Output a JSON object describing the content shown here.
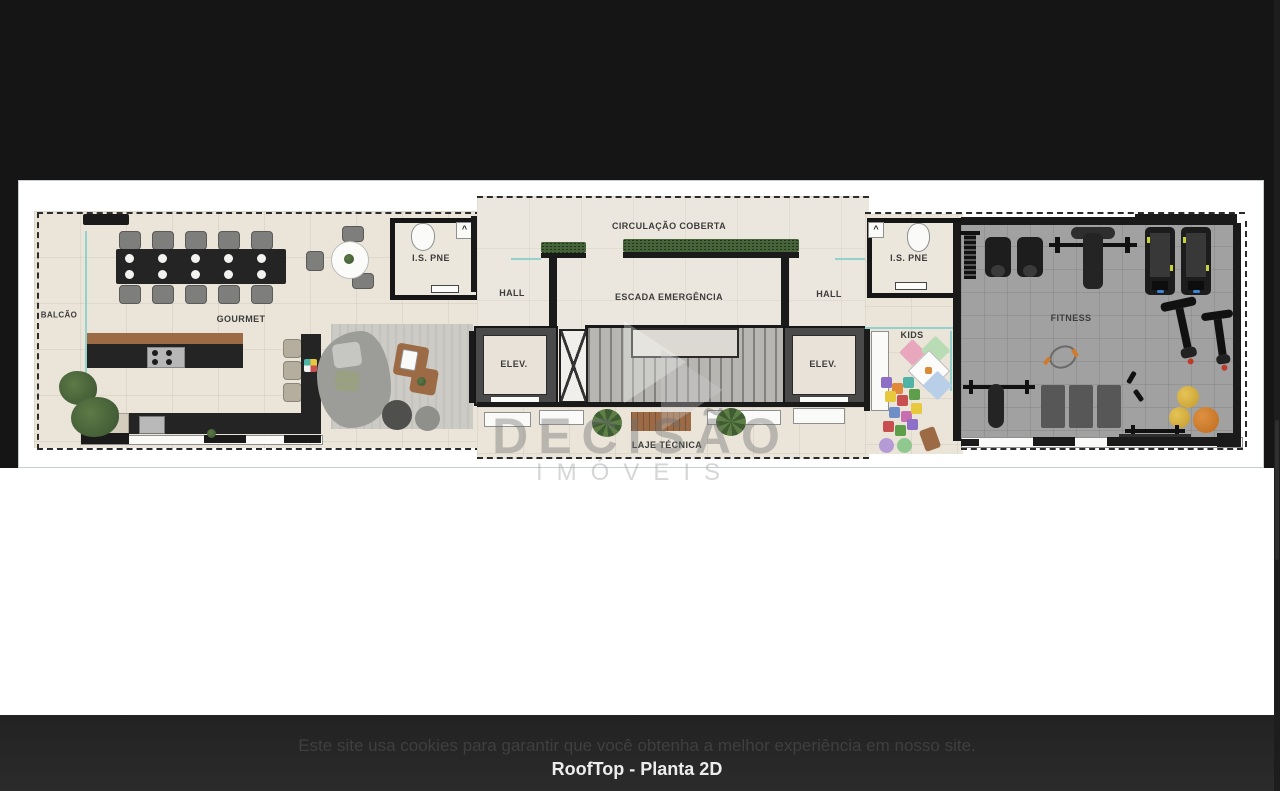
{
  "page": {
    "colors": {
      "top_background": "#151515",
      "footer_background": "#262626",
      "card_border": "#c7ccd1",
      "floor_beige": "#eae4d9",
      "fitness_gray": "#a1a1a1",
      "accent_teal": "#93d2cc",
      "planter_green": "#47633a",
      "wall_black": "#1a1a1a"
    },
    "footer": {
      "cookie_notice": "Este site usa cookies para garantir que você obtenha a melhor experiência em nosso site.",
      "caption": "RoofTop - Planta 2D"
    }
  },
  "floorplan": {
    "labels": {
      "balcao": "BALCÃO",
      "gourmet": "GOURMET",
      "is_pne_left": "I.S. PNE",
      "hall_left": "HALL",
      "circulacao_coberta": "CIRCULAÇÃO COBERTA",
      "escada_emergencia": "ESCADA EMERGÊNCIA",
      "hall_right": "HALL",
      "elev_left": "ELEV.",
      "elev_right": "ELEV.",
      "laje_tecnica": "LAJE TÉCNICA",
      "is_pne_right": "I.S. PNE",
      "kids": "KIDS",
      "fitness": "FITNESS"
    },
    "watermark": {
      "line1": "DECISÃO",
      "line2": "IMÓVEIS"
    }
  }
}
